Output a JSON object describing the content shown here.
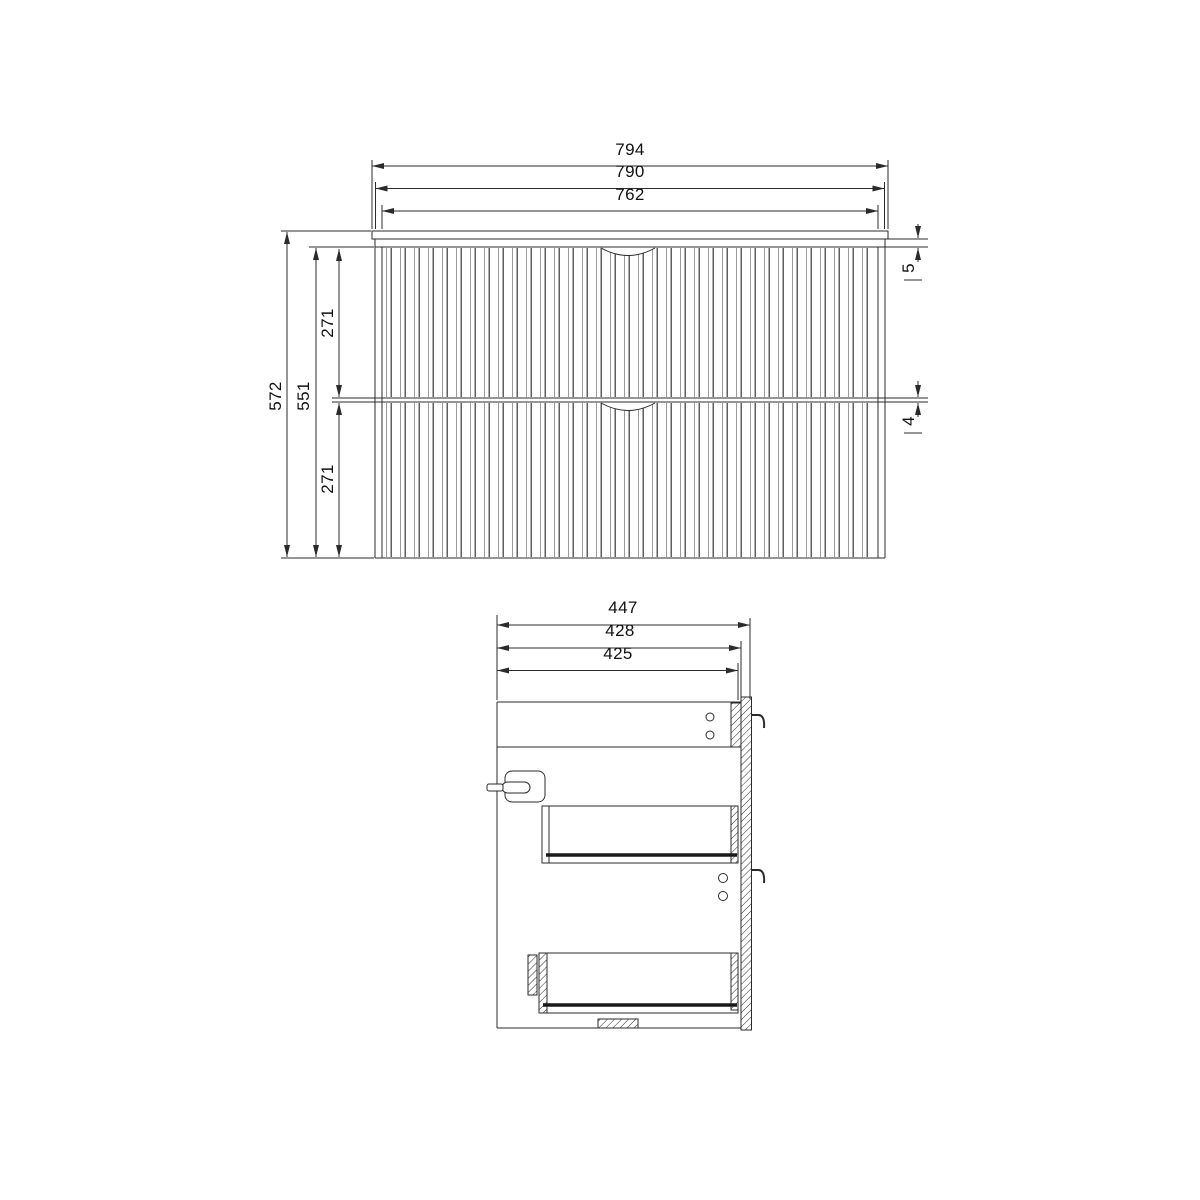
{
  "front_view": {
    "dim_width_overall": "794",
    "dim_width_carcass": "790",
    "dim_width_drawer_front": "762",
    "dim_height_overall": "572",
    "dim_height_carcass": "551",
    "dim_upper_drawer_front": "271",
    "dim_lower_drawer_front": "271",
    "dim_top_reveal": "5",
    "dim_middle_gap": "4"
  },
  "side_view": {
    "dim_depth_overall": "447",
    "dim_depth_carcass": "428",
    "dim_depth_drawer": "425"
  },
  "style": {
    "line_color": "#2b2b2b",
    "flute_dark": "#5f5f5f",
    "flute_light": "#9c9c9c",
    "background": "#ffffff"
  }
}
